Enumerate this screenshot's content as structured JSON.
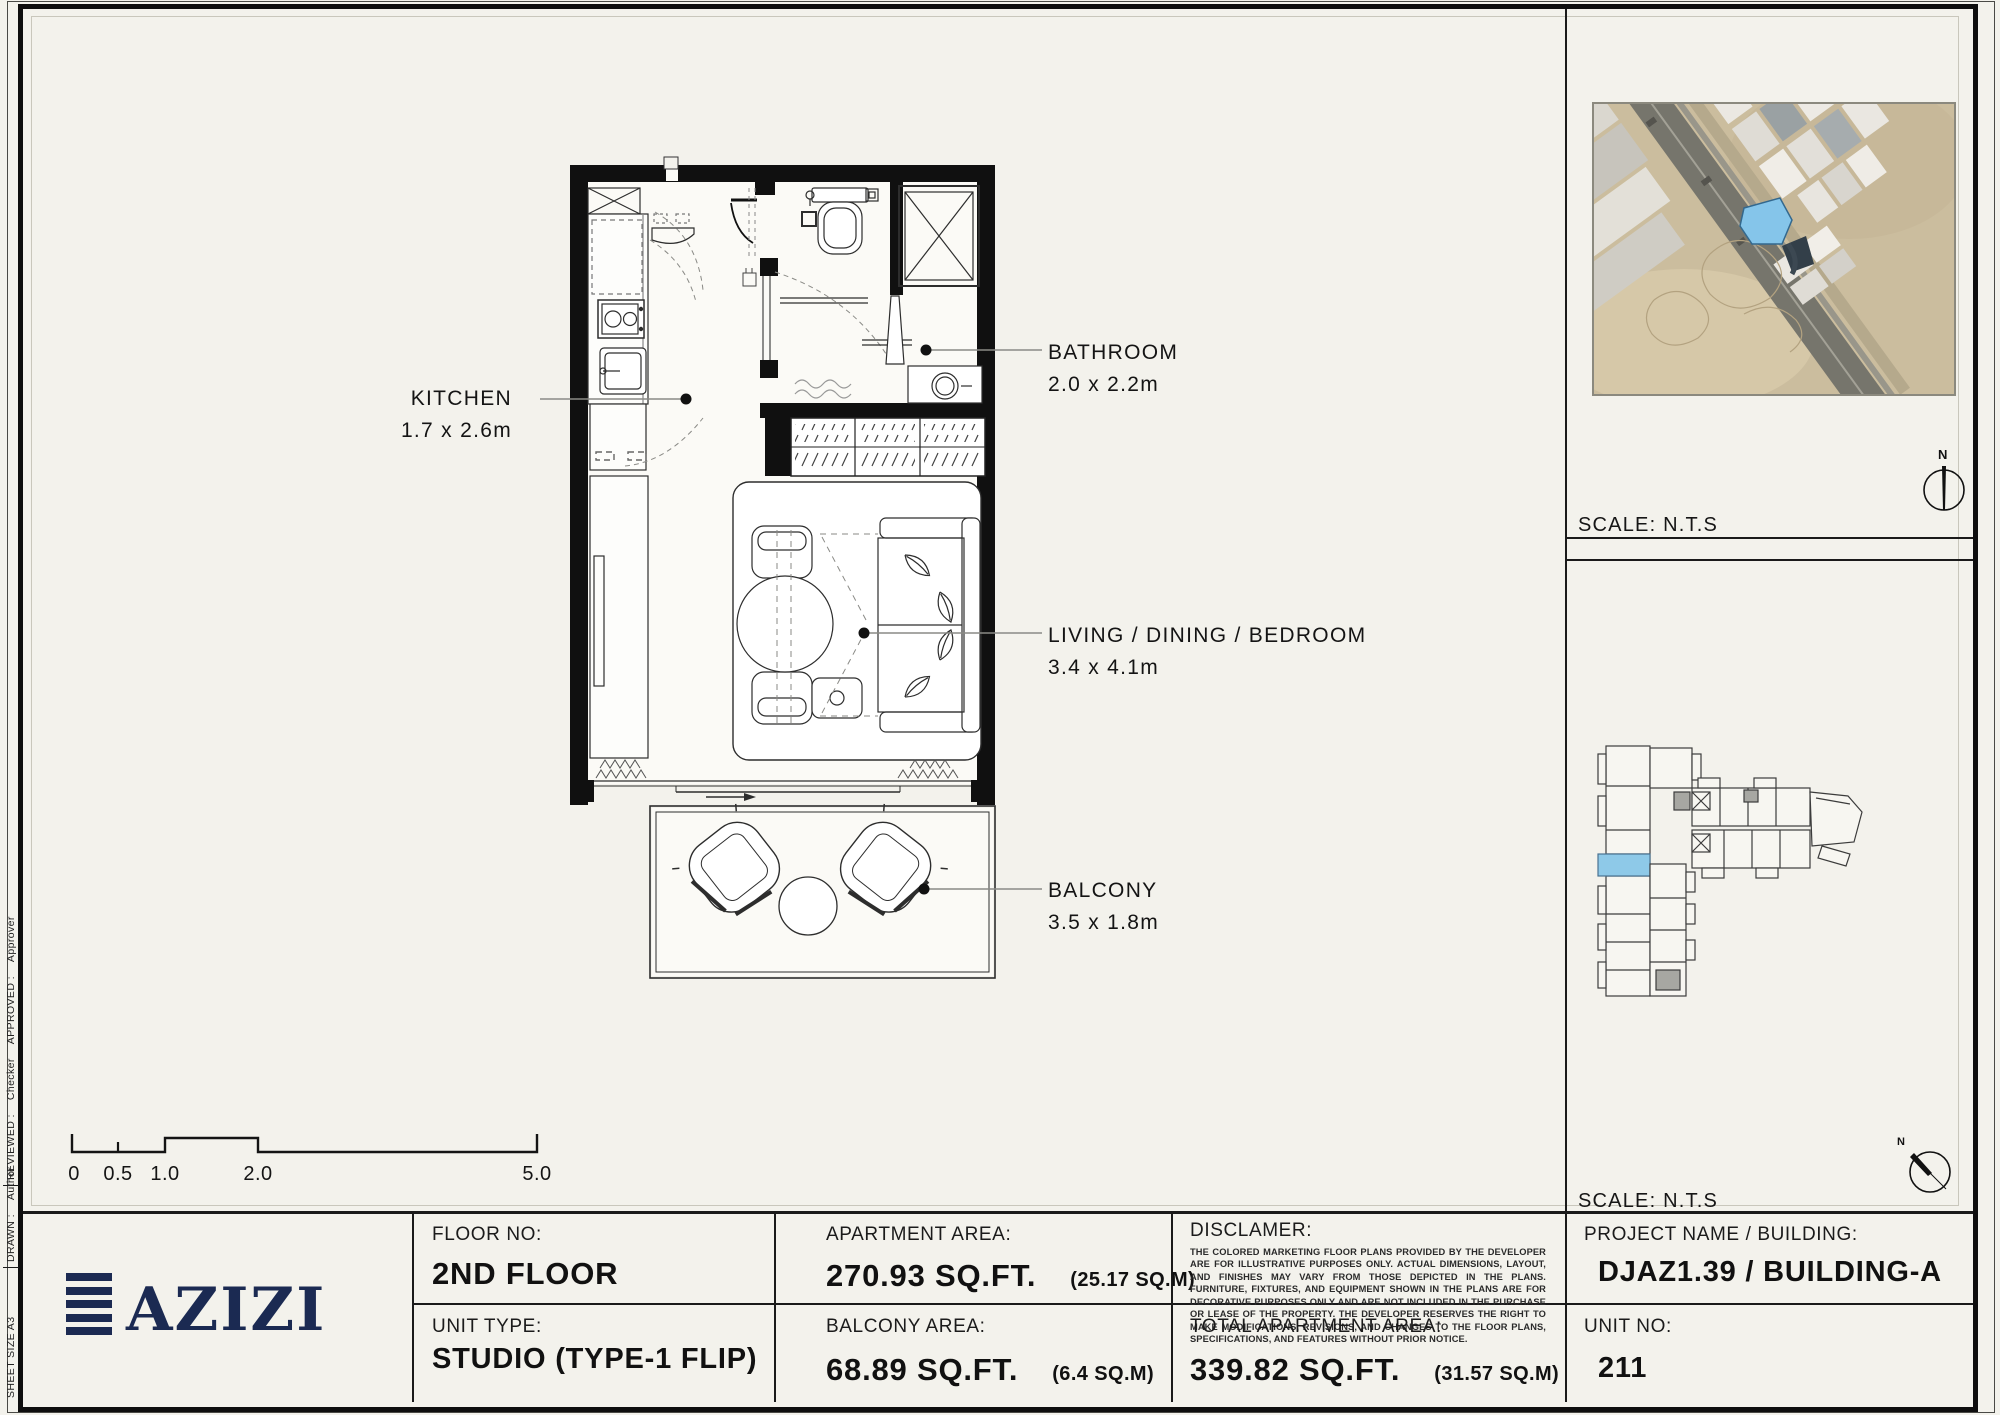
{
  "colors": {
    "page_bg": "#f3f2ec",
    "ink": "#141414",
    "brand_navy": "#1b2a52",
    "unit_highlight_blue": "#8ec9e8",
    "map_parcel_blue": "#85c5ea"
  },
  "edge_strip": {
    "sheet_size": "SHEET SIZE A3",
    "drawn_label": "DRAWN :",
    "drawn_value": "Author",
    "reviewed_label": "REVIEWED :",
    "reviewed_value": "Checker",
    "approved_label": "APPROVED :",
    "approved_value": "Approver"
  },
  "plan": {
    "labels": [
      {
        "name": "KITCHEN",
        "dims": "1.7 x 2.6m"
      },
      {
        "name": "BATHROOM",
        "dims": "2.0 x 2.2m"
      },
      {
        "name": "LIVING / DINING / BEDROOM",
        "dims": "3.4 x 4.1m"
      },
      {
        "name": "BALCONY",
        "dims": "3.5 x 1.8m"
      }
    ],
    "scale_bar": [
      "0",
      "0.5",
      "1.0",
      "2.0",
      "5.0"
    ]
  },
  "map_panel": {
    "scale": "SCALE: N.T.S",
    "north": "N"
  },
  "key_panel": {
    "scale": "SCALE: N.T.S",
    "north": "N"
  },
  "title_block": {
    "brand": "AZIZI",
    "floor_label": "FLOOR NO:",
    "floor_value": "2ND FLOOR",
    "unit_type_label": "UNIT TYPE:",
    "unit_type_value": "STUDIO (TYPE-1 FLIP)",
    "apt_area_label": "APARTMENT AREA:",
    "apt_area_value": "270.93 SQ.FT.",
    "apt_area_metric": "(25.17 SQ.M)",
    "balcony_area_label": "BALCONY AREA:",
    "balcony_area_value": "68.89 SQ.FT.",
    "balcony_area_metric": "(6.4 SQ.M)",
    "disclaimer_label": "DISCLAMER:",
    "disclaimer_body": "THE COLORED MARKETING FLOOR PLANS PROVIDED BY THE DEVELOPER ARE FOR ILLUSTRATIVE PURPOSES ONLY. ACTUAL DIMENSIONS, LAYOUT, AND FINISHES MAY VARY FROM THOSE DEPICTED IN THE PLANS. FURNITURE, FIXTURES, AND EQUIPMENT SHOWN IN THE PLANS ARE FOR DECORATIVE PURPOSES ONLY AND ARE NOT INCLUDED IN THE PURCHASE OR LEASE OF THE PROPERTY. THE DEVELOPER RESERVES THE RIGHT TO MAKE MODIFICATIONS, REVISIONS, AND CHANGES TO THE FLOOR PLANS, SPECIFICATIONS, AND FEATURES WITHOUT PRIOR NOTICE.",
    "total_area_label": "TOTAL APARTMENT AREA:",
    "total_area_value": "339.82 SQ.FT.",
    "total_area_metric": "(31.57 SQ.M)",
    "project_label": "PROJECT NAME / BUILDING:",
    "project_value": "DJAZ1.39 / BUILDING-A",
    "unit_no_label": "UNIT NO:",
    "unit_no_value": "211"
  }
}
